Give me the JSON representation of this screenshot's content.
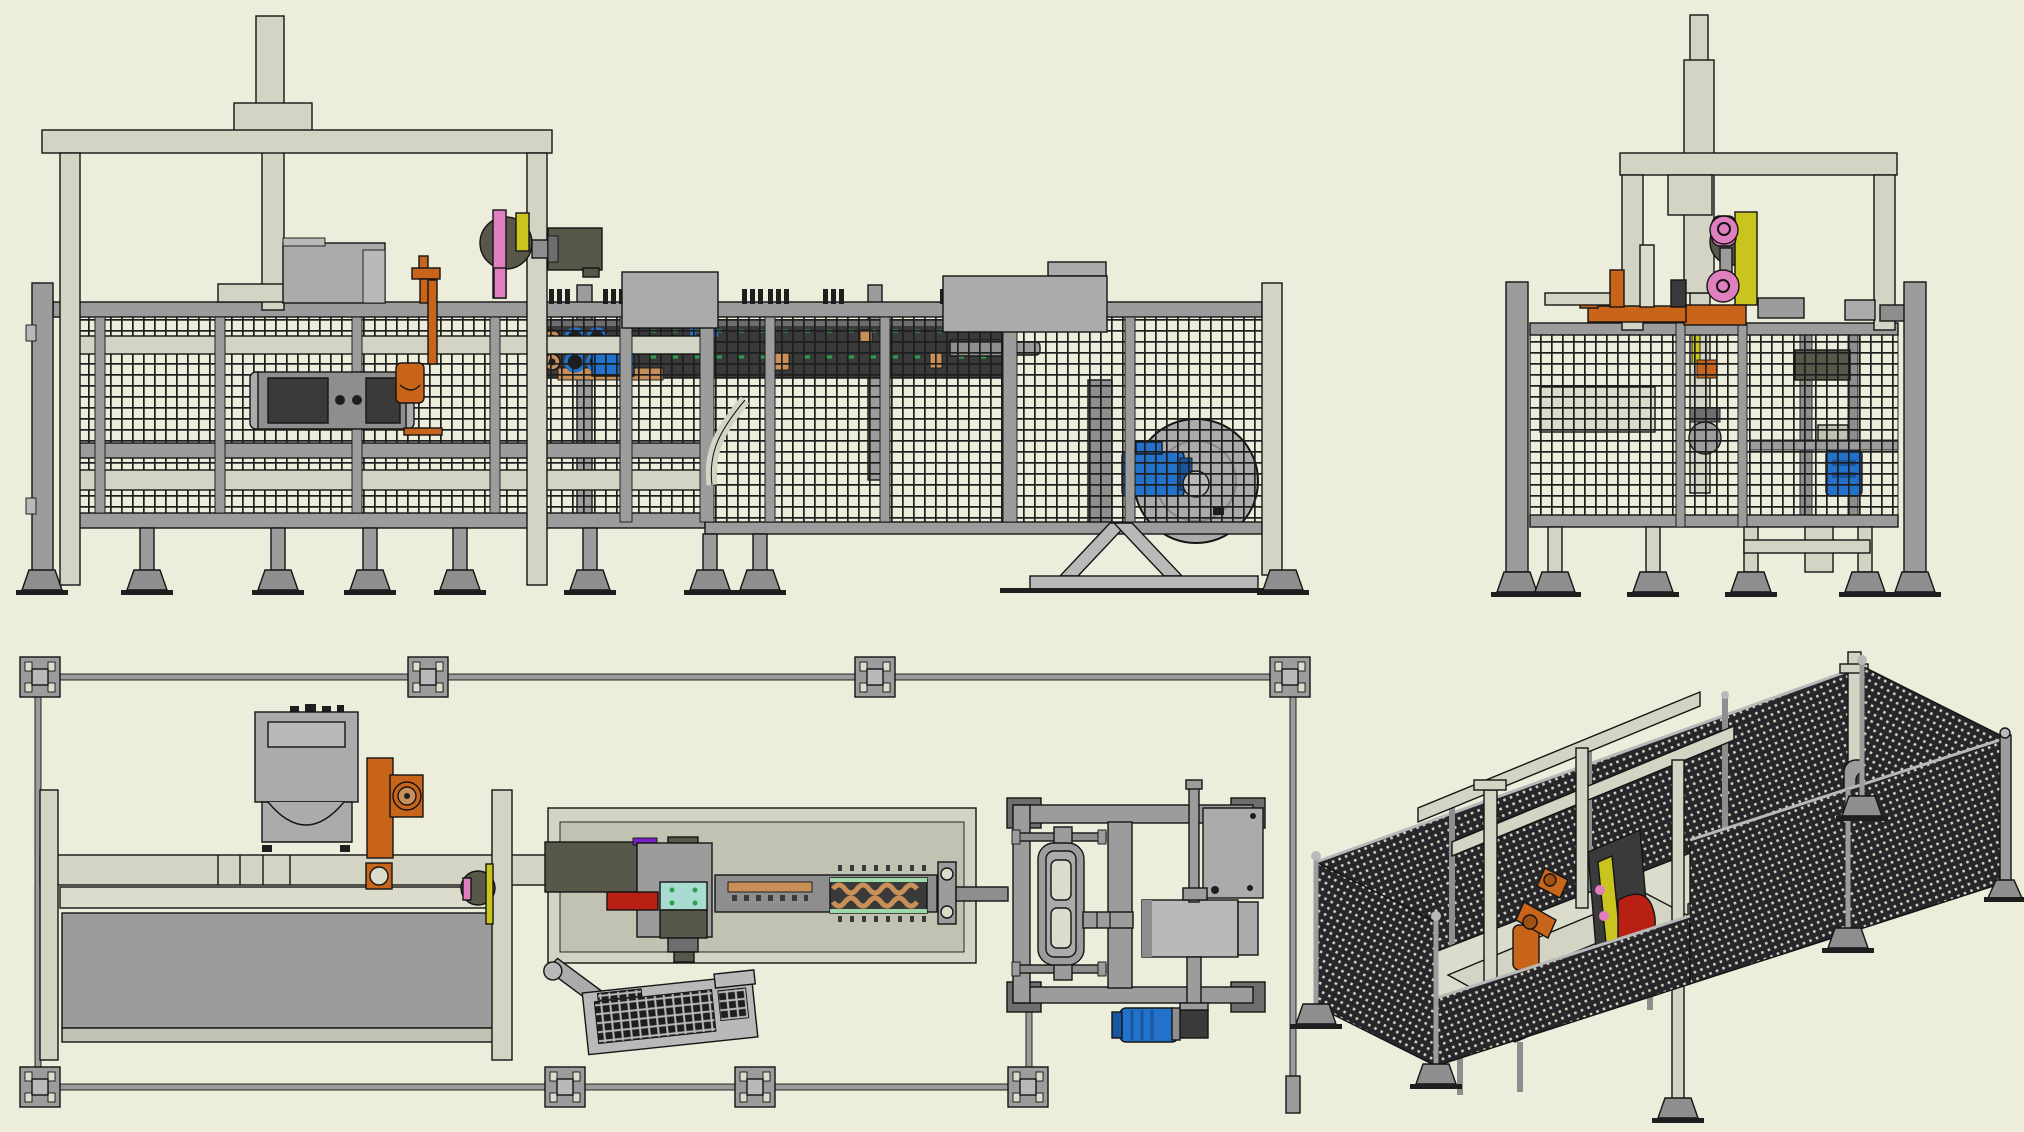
{
  "app": {
    "description": "CAD software export showing four orthographic/isometric views of a fenced sheet-metal forming production cell",
    "views": [
      {
        "id": "front-elevation-view",
        "position": "top-left"
      },
      {
        "id": "side-elevation-view",
        "position": "top-right"
      },
      {
        "id": "top-plan-view",
        "position": "bottom-left"
      },
      {
        "id": "isometric-view",
        "position": "bottom-right"
      }
    ]
  },
  "colors": {
    "bg": "#ECEDDA",
    "line": "#141414",
    "beige": "#D3D4C4",
    "beige_light": "#DCDCCC",
    "beige_dark": "#C2C2B2",
    "gray": "#9C9C9C",
    "gray_light": "#B9B9B9",
    "gray_mid": "#8E8E8E",
    "gray_dark": "#6E6E6E",
    "machine": "#ABABAB",
    "dark_box": "#3A3A3A",
    "near_black": "#1E1E1E",
    "orange": "#C8651A",
    "pink": "#E07FC0",
    "yellow": "#C9C51E",
    "blue": "#2272CC",
    "blue_dark": "#1A56A0",
    "teal": "#A8DCD0",
    "red": "#B82014",
    "olive": "#57574A",
    "copper": "#C89058",
    "green": "#2F9E4E",
    "purple": "#7A1FC8",
    "white": "#E8E8DC",
    "mesh_line": "#1E1E1E",
    "perf_bg": "#27272B",
    "perf_dot": "#CFCFBE"
  }
}
